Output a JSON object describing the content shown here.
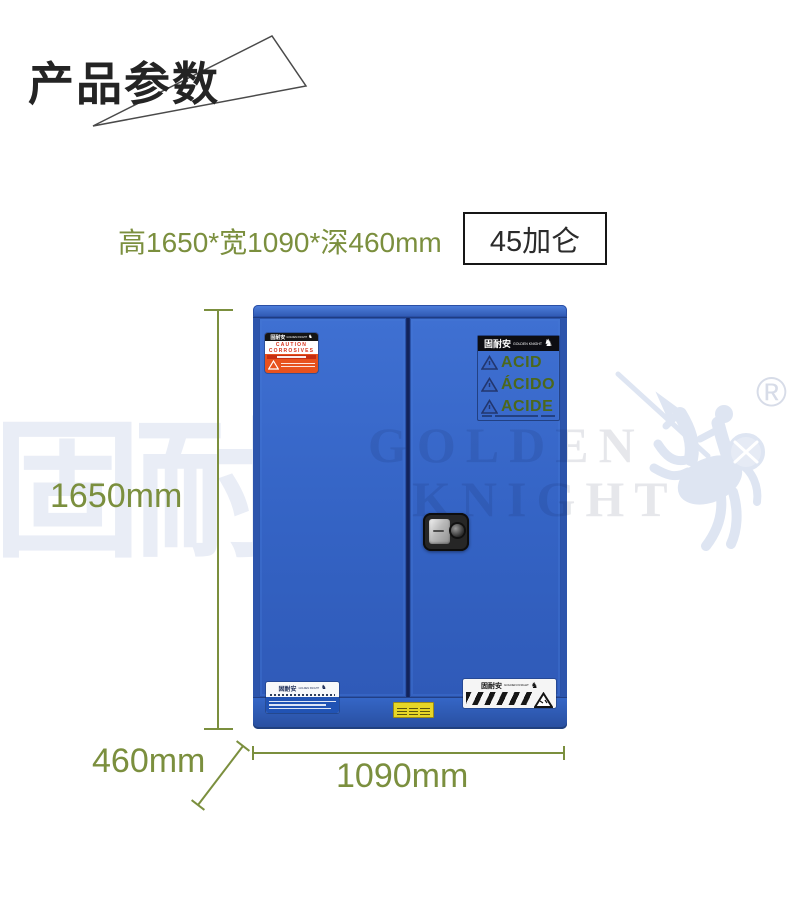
{
  "header": {
    "title": "产品参数"
  },
  "specs": {
    "dimensions": "高1650*宽1090*深460mm",
    "capacity": "45加仑"
  },
  "dimension_labels": {
    "height": "1650mm",
    "depth": "460mm",
    "width": "1090mm"
  },
  "brand": {
    "cn": "固耐安",
    "en": "GOLDEN KNIGHT",
    "en_line1": "GOLDEN",
    "en_line2": "KNIGHT",
    "registered": "®"
  },
  "icons": {
    "knight": "♞"
  },
  "cabinet": {
    "caution_label": {
      "line1": "CAUTION",
      "line2": "CORROSIVES"
    },
    "acid_label": {
      "rows": [
        "ACID",
        "ÁCIDO",
        "ACIDE"
      ]
    }
  },
  "colors": {
    "dimension_green": "#7b8f3e",
    "cabinet_blue": "#3565c4",
    "caution_orange": "#e8511d",
    "acid_text_green": "#4c681c",
    "watermark_light": "#e9edf6"
  }
}
